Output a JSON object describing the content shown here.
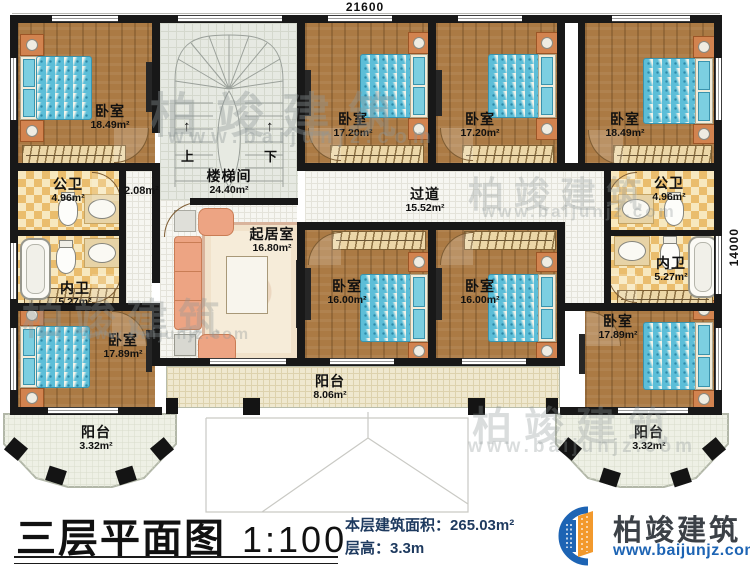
{
  "dimensions": {
    "width_top": "21600",
    "height_right": "14000"
  },
  "rooms": {
    "bedroom_tl": {
      "name": "卧室",
      "area": "18.49m²"
    },
    "bedroom_tm1": {
      "name": "卧室",
      "area": "17.20m²"
    },
    "bedroom_tm2": {
      "name": "卧室",
      "area": "17.20m²"
    },
    "bedroom_tr": {
      "name": "卧室",
      "area": "18.49m²"
    },
    "stairwell": {
      "name": "楼梯间",
      "area": "24.40m²",
      "up_label": "上",
      "down_label": "下"
    },
    "hall_small": {
      "area": "2.08m²"
    },
    "bath_public_left": {
      "name": "公卫",
      "area": "4.96m²"
    },
    "bath_private_left": {
      "name": "内卫",
      "area": "5.27m²"
    },
    "living_room": {
      "name": "起居室",
      "area": "16.80m²"
    },
    "corridor": {
      "name": "过道",
      "area": "15.52m²"
    },
    "bath_public_right": {
      "name": "公卫",
      "area": "4.96m²"
    },
    "bath_private_right": {
      "name": "内卫",
      "area": "5.27m²"
    },
    "bedroom_bl": {
      "name": "卧室",
      "area": "17.89m²"
    },
    "bedroom_bm1": {
      "name": "卧室",
      "area": "16.00m²"
    },
    "bedroom_bm2": {
      "name": "卧室",
      "area": "16.00m²"
    },
    "bedroom_br": {
      "name": "卧室",
      "area": "17.89m²"
    },
    "balcony_left": {
      "name": "阳台",
      "area": "3.32m²"
    },
    "balcony_center": {
      "name": "阳台",
      "area": "8.06m²"
    },
    "balcony_right": {
      "name": "阳台",
      "area": "3.32m²"
    }
  },
  "footer": {
    "title": "三层平面图",
    "scale": "1:100",
    "floor_area_label": "本层建筑面积：",
    "floor_area_value": "265.03m²",
    "floor_height_label": "层高：",
    "floor_height_value": "3.3m",
    "brand_name": "柏竣建筑",
    "brand_website": "www.baijunjz.com"
  },
  "watermark": {
    "brand": "柏竣建筑",
    "website": "www.baijunjz.com"
  },
  "colors": {
    "wall": "#181818",
    "wood_floor": "#ab7a44",
    "bed_teal": "#5cbed8",
    "tile_light": "#f7e8bf",
    "tile_dark": "#eabd6d",
    "brand_blue": "#1d64b4",
    "brand_orange": "#f2992d",
    "info_text": "#1e3a5f"
  }
}
